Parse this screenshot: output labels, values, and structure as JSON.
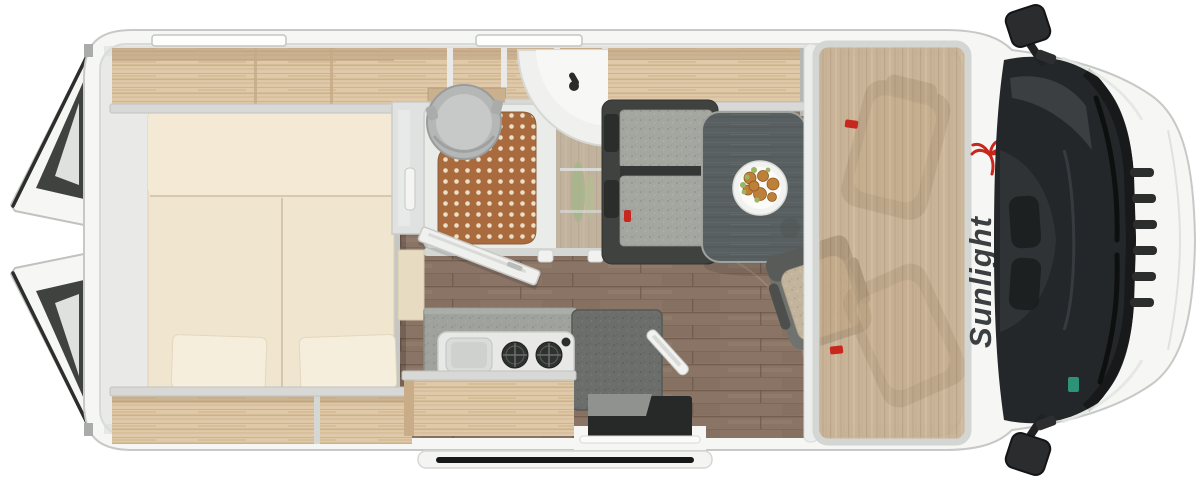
{
  "brand": {
    "logo_text": "Sunlight"
  },
  "palette": {
    "background": "#ffffff",
    "body_white": "#f6f7f5",
    "body_edge": "#c6c9c6",
    "wall_light": "#e9eae7",
    "wall_mid": "#d5d7d4",
    "wood_light": "#dfc9a8",
    "wood_face": "#d8d9d6",
    "floor_brown": "#8a7466",
    "mattress_cream": "#f0e5ce",
    "pillow_cream": "#f6eedd",
    "tray_white": "#eaecea",
    "mat_orange": "#a96b3e",
    "mat_dot": "#ecdfc8",
    "toilet_gray": "#b4b7b6",
    "basin_white": "#f0f1ef",
    "glass_frost": "#dfe2e0",
    "plant_green": "#7f9a55",
    "counter_gray": "#9fa29d",
    "hob_white": "#e8e9e6",
    "burner_black": "#2e3130",
    "table_dark": "#596061",
    "bench_dark": "#3f423e",
    "cushion_gray": "#a4a6a0",
    "cushion_beige": "#c3b59d",
    "step_dark": "#272928",
    "glass_dark": "#24272a",
    "accent_red": "#c8271d",
    "sticker_green": "#2f9f80",
    "logo_dark": "#3c3f41"
  },
  "scene": {
    "view": "top-down camper van floorplan render",
    "element_names": [
      "rear-door-top",
      "rear-door-bottom",
      "rear-bed",
      "pillows",
      "overhead-shelves",
      "shower-tray",
      "shower-mat",
      "toilet",
      "corner-basin",
      "wardrobe",
      "bathroom-door",
      "kitchen-counter",
      "hob-sink-unit",
      "worktop-extension",
      "dinette-bench",
      "dinette-table",
      "food-plate",
      "swivel-seat",
      "over-cab-panel",
      "seatbelt-markers",
      "entry-step",
      "exterior-step-board",
      "roof-window-strips",
      "windshield",
      "wipers",
      "grille",
      "side-mirror-top",
      "side-mirror-bottom",
      "brand-logo"
    ],
    "counts": {
      "burners": 2,
      "roof_window_strips": 2,
      "rear_door_panels": 2
    }
  }
}
